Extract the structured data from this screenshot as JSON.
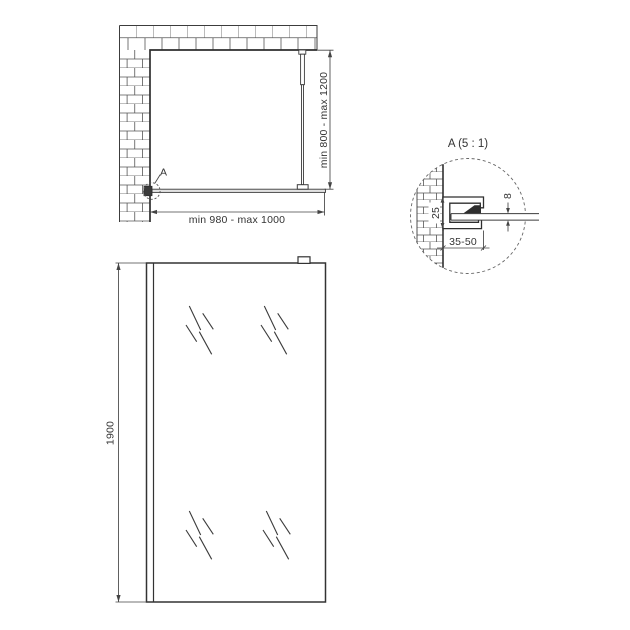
{
  "drawing": {
    "type": "technical-drawing",
    "subject": "walk-in shower glass panel installation drawing",
    "colors": {
      "background": "#ffffff",
      "line": "#3c3c3c",
      "brick_joint": "#555555",
      "text": "#333333"
    },
    "top_view": {
      "width_label": "min 980 - max 1000",
      "height_label": "min 800 - max 1200",
      "detail_marker_label": "A"
    },
    "front_view": {
      "height_label": "1900"
    },
    "detail_view": {
      "title": "A (5 : 1)",
      "profile_height_label": "25",
      "glass_thickness_label": "8",
      "mount_depth_label": "35-50"
    }
  }
}
